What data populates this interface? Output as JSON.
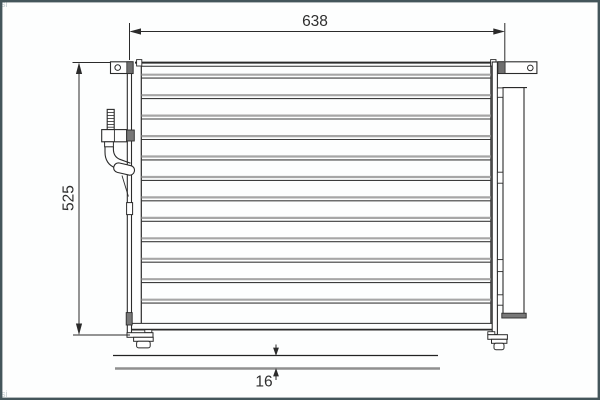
{
  "window": {
    "background_color": "#fdfefe",
    "frame_color": "#44565b"
  },
  "diagram": {
    "type": "technical-drawing",
    "subject": "automotive-condenser-front-view",
    "line_color": "#2b2b2b",
    "tube_gray_color": "#a6a6a6",
    "hatch_fill_color": "#787878",
    "dimensions": {
      "width": {
        "value": "638",
        "orientation": "horizontal",
        "position": "top"
      },
      "height": {
        "value": "525",
        "orientation": "vertical-rotated",
        "position": "left"
      },
      "depth": {
        "value": "16",
        "orientation": "vertical",
        "position": "bottom"
      }
    },
    "parts": [
      "core-with-horizontal-tubes",
      "left-header-tank",
      "right-header-tank",
      "receiver-drier-cylinder",
      "threaded-inlet-fitting",
      "elbow-outlet-pipe",
      "top-left-mounting-bracket-with-hole",
      "top-right-mounting-bracket-with-hole",
      "bottom-left-mounting-foot",
      "bottom-right-mounting-foot"
    ],
    "watermark": "si"
  }
}
